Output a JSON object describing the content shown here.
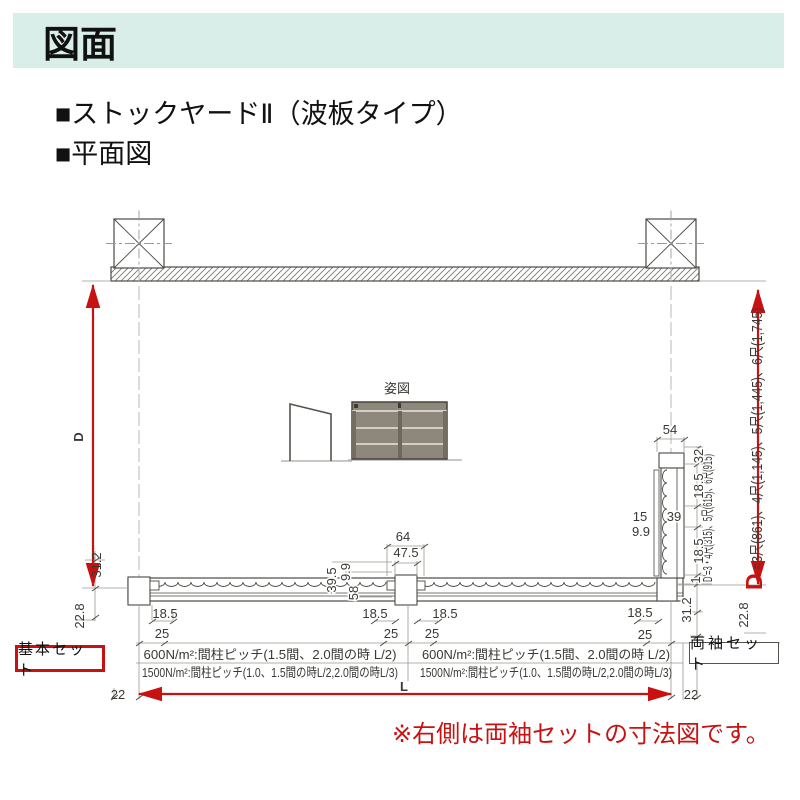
{
  "colors": {
    "banner_bg": "#daeee9",
    "accent_red": "#c81212",
    "line_dark": "#4b4944",
    "line_dim": "#9a988f",
    "panel_gray": "#8e877b"
  },
  "header": {
    "title": "図面",
    "heading1": "■ストックヤードⅡ（波板タイプ）",
    "heading2": "■平面図"
  },
  "drawing": {
    "view_label": "姿図",
    "labels": {
      "d": "D",
      "l": "L",
      "v54": "54",
      "v64": "64",
      "v47_5": "47.5",
      "v32": "32",
      "v18_5": "18.5",
      "v25": "25",
      "v22": "22",
      "v31_2": "31.2",
      "v22_8": "22.8",
      "v39_5": "39.5",
      "v9_9": "9.9",
      "v58": "58",
      "v15": "15",
      "v39": "39",
      "v1": "1",
      "d_eq_d": "D",
      "d_eq_rest": "=3尺(861)、4尺(1,145)、5尺(1,445)、6尺(1,745)",
      "d_prime": "D'=3・4尺(315)、5尺(615)、6尺(915)"
    },
    "notes": {
      "pitch600": "600N/m²:間柱ピッチ(1.5間、2.0間の時 L/2)",
      "pitch1500": "1500N/m²:間柱ピッチ(1.0、1.5間の時L/2,2.0間の時L/3)"
    }
  },
  "footer": {
    "basic_set": "基本セット",
    "double_set": "両袖セット",
    "note": "※右側は両袖セットの寸法図です。"
  }
}
